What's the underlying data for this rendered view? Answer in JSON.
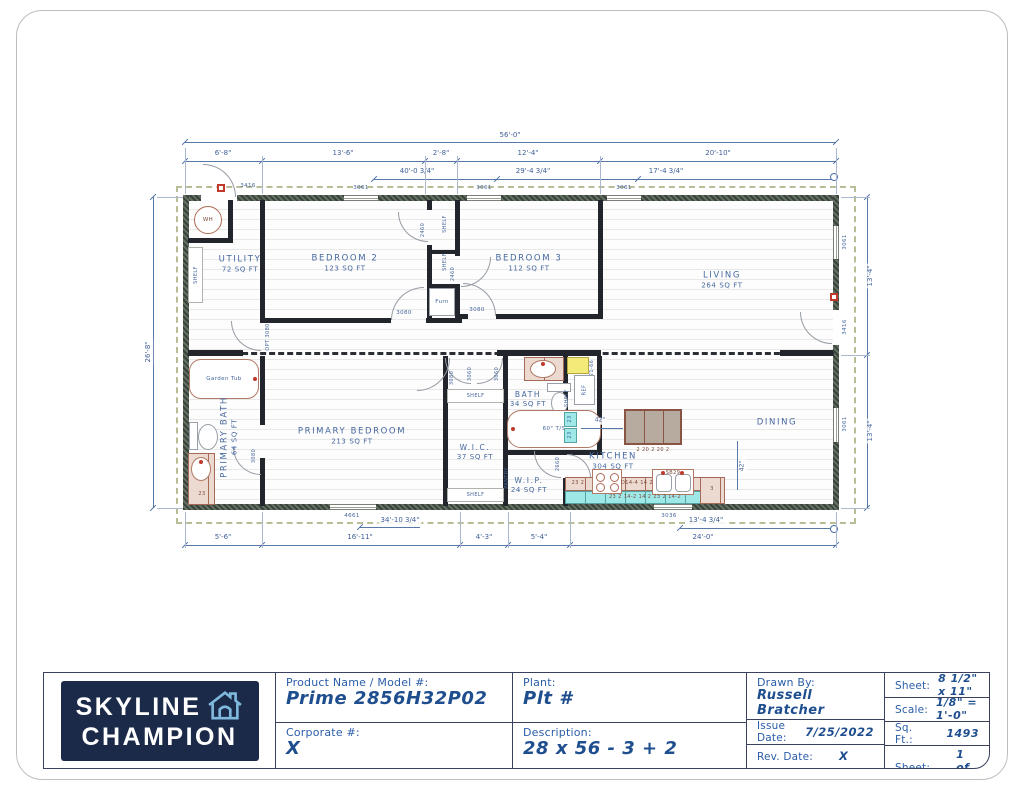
{
  "plan": {
    "dims": {
      "overall": "56'-0\"",
      "top_row": [
        "6'-8\"",
        "13'-6\"",
        "2'-8\"",
        "12'-4\"",
        "20'-10\""
      ],
      "top_secondary": [
        "40'-0 3/4\"",
        "29'-4 3/4\"",
        "17'-4 3/4\""
      ],
      "left_height": "26'-8\"",
      "right_upper": "13'-4\"",
      "right_lower": "13'-4\"",
      "bottom_row": [
        "5'-6\"",
        "16'-11\"",
        "4'-3\"",
        "5'-4\"",
        "24'-0\""
      ],
      "bottom_secondary": [
        "34'-10 3/4\"",
        "13'-4 3/4\""
      ],
      "kitchen_clearance_a": "42\"",
      "kitchen_clearance_b": "42\""
    },
    "windows": {
      "w3061": "3061",
      "w4661": "4661",
      "w3036": "3036"
    },
    "doors": {
      "entry": "3416",
      "rear": "3416",
      "closet": "2460",
      "bed": "3080",
      "utility_opt": "OPT 3080",
      "interior_3060": "3060",
      "bath_2660": "2660"
    },
    "rooms": {
      "utility": {
        "name": "UTILITY",
        "area": "72 SQ FT"
      },
      "bedroom2": {
        "name": "BEDROOM 2",
        "area": "123 SQ FT"
      },
      "bedroom3": {
        "name": "BEDROOM 3",
        "area": "112 SQ FT"
      },
      "living": {
        "name": "LIVING",
        "area": "264 SQ FT"
      },
      "primary_bath": {
        "name": "PRIMARY BATH",
        "area": "64 SQ FT"
      },
      "primary_bedroom": {
        "name": "PRIMARY BEDROOM",
        "area": "213 SQ FT"
      },
      "wic": {
        "name": "W.I.C.",
        "area": "37 SQ FT"
      },
      "bath": {
        "name": "BATH",
        "area": "34 SQ FT"
      },
      "wip": {
        "name": "W.I.P.",
        "area": "24 SQ FT"
      },
      "kitchen": {
        "name": "KITCHEN",
        "area": "304 SQ FT"
      },
      "dining": {
        "name": "DINING"
      }
    },
    "fixtures": {
      "water_heater": "WH",
      "garden_tub": "Garden Tub",
      "furnace": "Furn",
      "fridge": "REF",
      "tub_shower": "60\" T/S",
      "shelf": "SHELF",
      "pantry": "PANTRY"
    },
    "cabinets": {
      "island": "2   20   2   20   2",
      "run_a": "23  2",
      "run_b": "D14-4  14  2",
      "sink": "SB29",
      "run_c": "23  3",
      "run_lower": "23  2  14-2  14  2  23  2  14-2",
      "bath_a": "23",
      "bath_b": "23",
      "fridge_over": "21-66",
      "vanity": "23",
      "dining_end": "3"
    }
  },
  "title_block": {
    "logo": {
      "line1": "SKYLINE",
      "line2": "CHAMPION"
    },
    "product_label": "Product Name / Model #:",
    "product_value": "Prime 2856H32P02",
    "corporate_label": "Corporate #:",
    "corporate_value": "X",
    "plant_label": "Plant:",
    "plant_value": "Plt #",
    "description_label": "Description:",
    "description_value": "28 x 56 - 3 + 2",
    "drawn_by_label": "Drawn By:",
    "drawn_by_value": "Russell Bratcher",
    "issue_date_label": "Issue Date:",
    "issue_date_value": "7/25/2022",
    "rev_date_label": "Rev. Date:",
    "rev_date_value": "X",
    "sheet_size_label": "Sheet:",
    "sheet_size_value": "8 1/2\" x 11\"",
    "scale_label": "Scale:",
    "scale_value": "1/8\" = 1'-0\"",
    "sqft_label": "Sq. Ft.:",
    "sqft_value": "1493",
    "sheet_num_label": "Sheet:",
    "sheet_num_value": "1 of 6"
  }
}
